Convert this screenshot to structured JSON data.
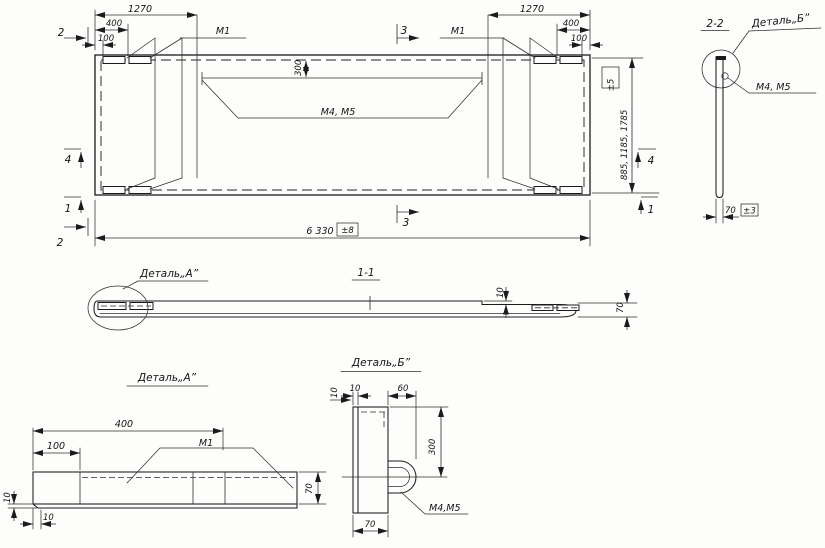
{
  "main_view": {
    "dim_1270_left": "1270",
    "dim_400_left": "400",
    "dim_100_left": "100",
    "dim_1270_right": "1270",
    "dim_400_right": "400",
    "dim_100_right": "100",
    "label_m1_left": "М1",
    "label_m1_right": "М1",
    "label_m4_m5": "М4, М5",
    "dim_300": "300",
    "dim_length": "6 330",
    "tol_length": "±8",
    "dim_heights": "885, 1185, 1785",
    "tol_heights": "±5",
    "marker_1": "1",
    "marker_2": "2",
    "marker_3": "3",
    "marker_4": "4"
  },
  "section_1_1": {
    "title": "1-1",
    "callout_detail_a": "Деталь„А”",
    "dim_10": "10",
    "dim_70": "70"
  },
  "section_2_2": {
    "title": "2-2",
    "callout_detail_b": "Деталь„Б”",
    "label_m4_m5": "М4, М5",
    "dim_70": "70",
    "tol": "±3"
  },
  "detail_a": {
    "title": "Деталь„А”",
    "dim_400": "400",
    "dim_100": "100",
    "label_m1": "М1",
    "dim_70": "70",
    "dim_10": "10",
    "dim_10_side": "10"
  },
  "detail_b": {
    "title": "Деталь„Б”",
    "dim_10": "10",
    "dim_60": "60",
    "dim_300": "300",
    "dim_70": "70",
    "dim_10_side": "10",
    "label_m4_m5": "М4,М5"
  }
}
